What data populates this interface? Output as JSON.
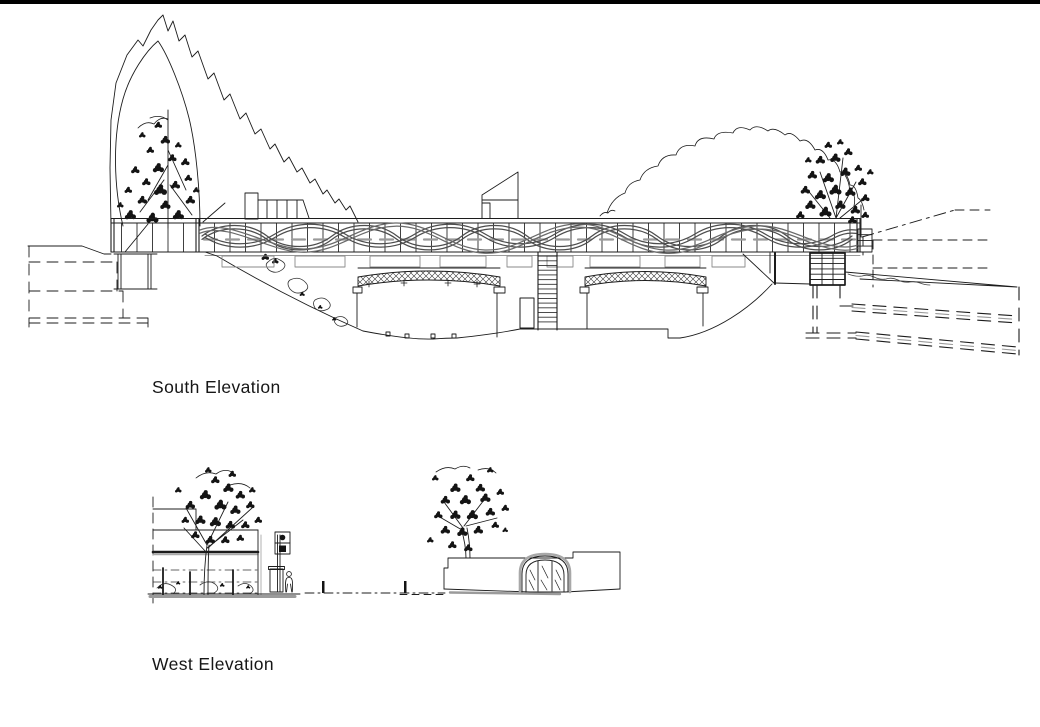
{
  "sheet": {
    "background": "#ffffff",
    "ink_color": "#1c1c1c",
    "gray_color": "#8c8c8c"
  },
  "drawings": {
    "south": {
      "label": "South Elevation"
    },
    "west": {
      "label": "West Elevation"
    }
  }
}
